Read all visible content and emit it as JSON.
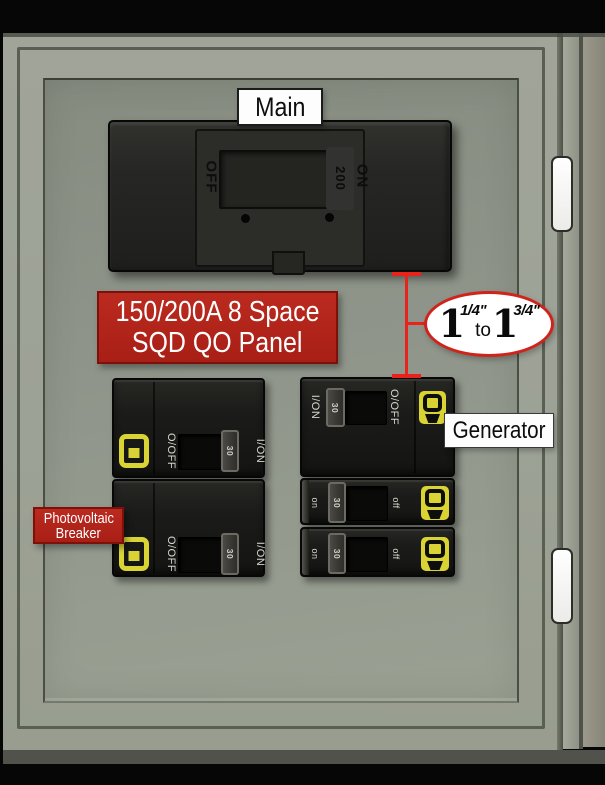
{
  "labels": {
    "main": "Main",
    "generator": "Generator",
    "photovoltaic_line1": "Photovoltaic",
    "photovoltaic_line2": "Breaker"
  },
  "panel_label": {
    "line1": "150/200A 8 Space",
    "line2": "SQD QO Panel"
  },
  "dimension_callout": {
    "num1": "1",
    "frac1": "1/4\"",
    "conjunction": "to",
    "num2": "1",
    "frac2": "3/4\""
  },
  "main_breaker": {
    "off_label": "OFF",
    "rating": "200",
    "on_label": "ON"
  },
  "breakers": {
    "left_top": {
      "off_label": "O/OFF",
      "rating": "30",
      "on_label": "I/ON"
    },
    "left_bottom": {
      "off_label": "O/OFF",
      "rating": "30",
      "on_label": "I/ON"
    },
    "generator": {
      "on_label": "I/ON",
      "rating": "30",
      "off_label": "O/OFF"
    },
    "right_middle": {
      "on_label": "on",
      "rating": "30",
      "off_label": "off"
    },
    "right_bottom": {
      "on_label": "on",
      "rating": "30",
      "off_label": "off"
    }
  },
  "colors": {
    "cabinet_gray": "#9da296",
    "recess_panel_gray": "#8f958a",
    "breaker_black": "#1a1a18",
    "square_d_yellow": "#d9d334",
    "label_red": "#b4231a",
    "dimension_red": "#e8231b",
    "callout_border_red": "#cf241c"
  }
}
